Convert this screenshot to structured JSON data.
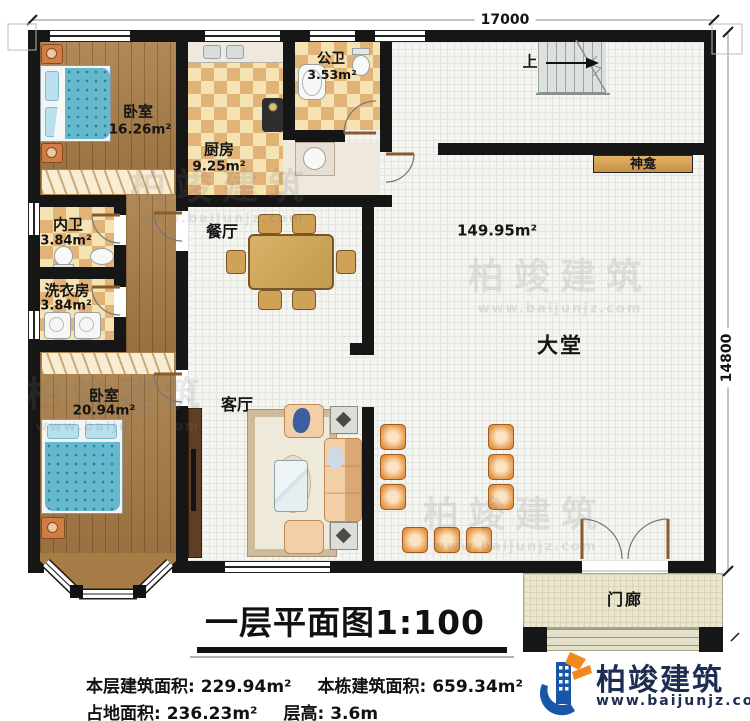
{
  "title": {
    "text": "一层平面图1:100"
  },
  "dimensions": {
    "width": "17000",
    "height": "14800"
  },
  "rooms": {
    "bedroom1": {
      "name": "卧室",
      "area": "16.26m²"
    },
    "kitchen": {
      "name": "厨房",
      "area": "9.25m²"
    },
    "public_bath": {
      "name": "公卫",
      "area": "3.53m²"
    },
    "ensuite_bath": {
      "name": "内卫",
      "area": "3.84m²"
    },
    "laundry": {
      "name": "洗衣房",
      "area": "3.84m²"
    },
    "bedroom2": {
      "name": "卧室",
      "area": "20.94m²"
    },
    "dining": {
      "name": "餐厅"
    },
    "living": {
      "name": "客厅"
    },
    "lobby": {
      "name": "大堂",
      "area": "149.95m²"
    },
    "shrine": {
      "name": "神龛"
    },
    "stairs": {
      "direction": "上"
    },
    "porch": {
      "name": "门廊"
    }
  },
  "stats": {
    "floor_area": "本层建筑面积: 229.94m²",
    "total_area": "本栋建筑面积: 659.34m²",
    "footprint": "占地面积: 236.23m²",
    "floor_height": "层高: 3.6m"
  },
  "brand": {
    "name": "柏竣建筑",
    "site": "www.baijunjz.com"
  },
  "colors": {
    "wall": "#161616",
    "wood_floor": "#a87c46",
    "tile_checker": "#e2b377",
    "brand_blue": "#1a56a8",
    "brand_orange": "#f08a1e",
    "chair_orange": "#e09048",
    "bed_blue": "#64b9ce"
  }
}
